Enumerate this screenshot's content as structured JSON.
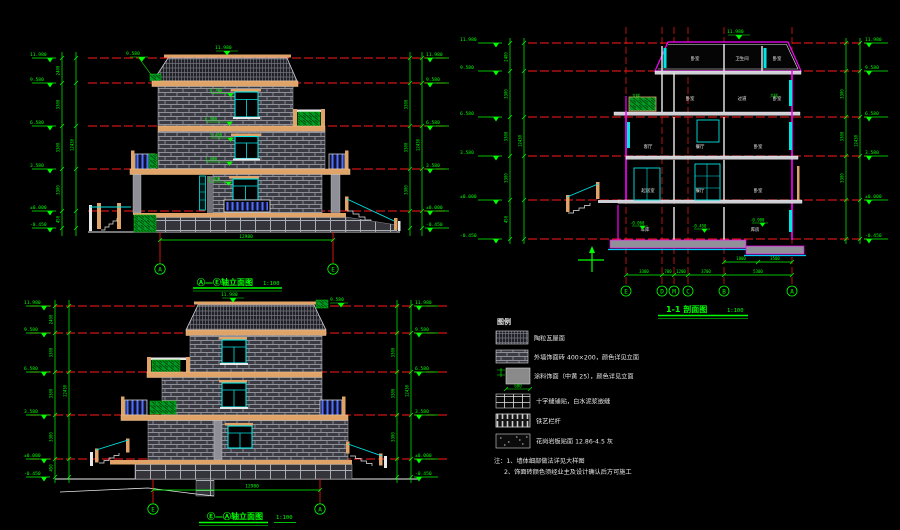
{
  "titles": {
    "front": {
      "label": "Ⓐ—Ⓔ轴立面图",
      "scale": "1:100"
    },
    "rear": {
      "label": "Ⓔ—Ⓐ轴立面图",
      "scale": "1:100"
    },
    "section": {
      "label": "1-1 剖面图",
      "scale": "1:100"
    }
  },
  "levels": {
    "l1": "11.980",
    "l2": "9.580",
    "l3": "6.580",
    "l4": "3.580",
    "l5": "±0.000",
    "l6": "-0.450"
  },
  "vdims": {
    "d1": "2400",
    "d2": "3300",
    "d3": "3300",
    "d4": "3300",
    "d5": "450"
  },
  "vtotal": "12430",
  "front": {
    "axis_left": "A",
    "axis_right": "E",
    "overall": "12980",
    "win": {
      "w1": "8.700",
      "w2": "6.900",
      "w3": "5.400",
      "w4": "3.600",
      "w5": "2.400",
      "w6": "0.900"
    }
  },
  "rear": {
    "axis_left": "E",
    "axis_right": "A",
    "overall": "12980",
    "win": {
      "w1": "8.700",
      "w2": "5.400",
      "w3": "2.400"
    }
  },
  "section": {
    "axes": {
      "a1": "E",
      "a2": "D",
      "a3": "M",
      "a4": "C",
      "a5": "B",
      "a6": "A"
    },
    "dims": {
      "d1": "3300",
      "d2": "700",
      "d3": "1200",
      "d4": "3700",
      "d5": "5300",
      "s1": "1800",
      "s2": "3500"
    },
    "rooms": {
      "attic": [
        "卧室",
        "卫生间",
        "卧室"
      ],
      "f3": [
        "卧室",
        "过道",
        "卧室"
      ],
      "f2": [
        "客厅",
        "餐厅",
        "卧室"
      ],
      "f1": [
        "起居室",
        "餐厅",
        "卧室"
      ],
      "base": [
        "车库",
        "库房"
      ]
    },
    "marks": {
      "m1": "-0.060",
      "m2": "-0.450",
      "m3": "-0.900"
    },
    "callout": "大样"
  },
  "legend": {
    "heading": "图例",
    "items": [
      {
        "label": "陶粒瓦屋面"
      },
      {
        "label": "外墙饰面砖 400×200，颜色详见立面"
      },
      {
        "label": "涂料饰面（中黄 25），颜色详见立面",
        "dim": "600"
      },
      {
        "label": "十字缝铺贴，白水泥浆嵌缝"
      },
      {
        "label": "铁艺栏杆"
      },
      {
        "label": "花岗岩板贴面 12.86-4.5 灰"
      }
    ],
    "notes": {
      "n1": "注：1、墙体细部做法详见大样图",
      "n2": "2、饰面砖颜色须经业主及设计确认后方可施工"
    }
  },
  "colors": {
    "background": "#000000",
    "dimension_green": "#00ff00",
    "level_red": "#ff0000",
    "window_cyan": "#00e5e5",
    "trim_orange": "#e0a468",
    "section_outline": "#ff00ff",
    "wall_gray": "#3b3b43",
    "white": "#ededed",
    "planter_green": "#009922",
    "railing_blue": "#4f6fff"
  }
}
